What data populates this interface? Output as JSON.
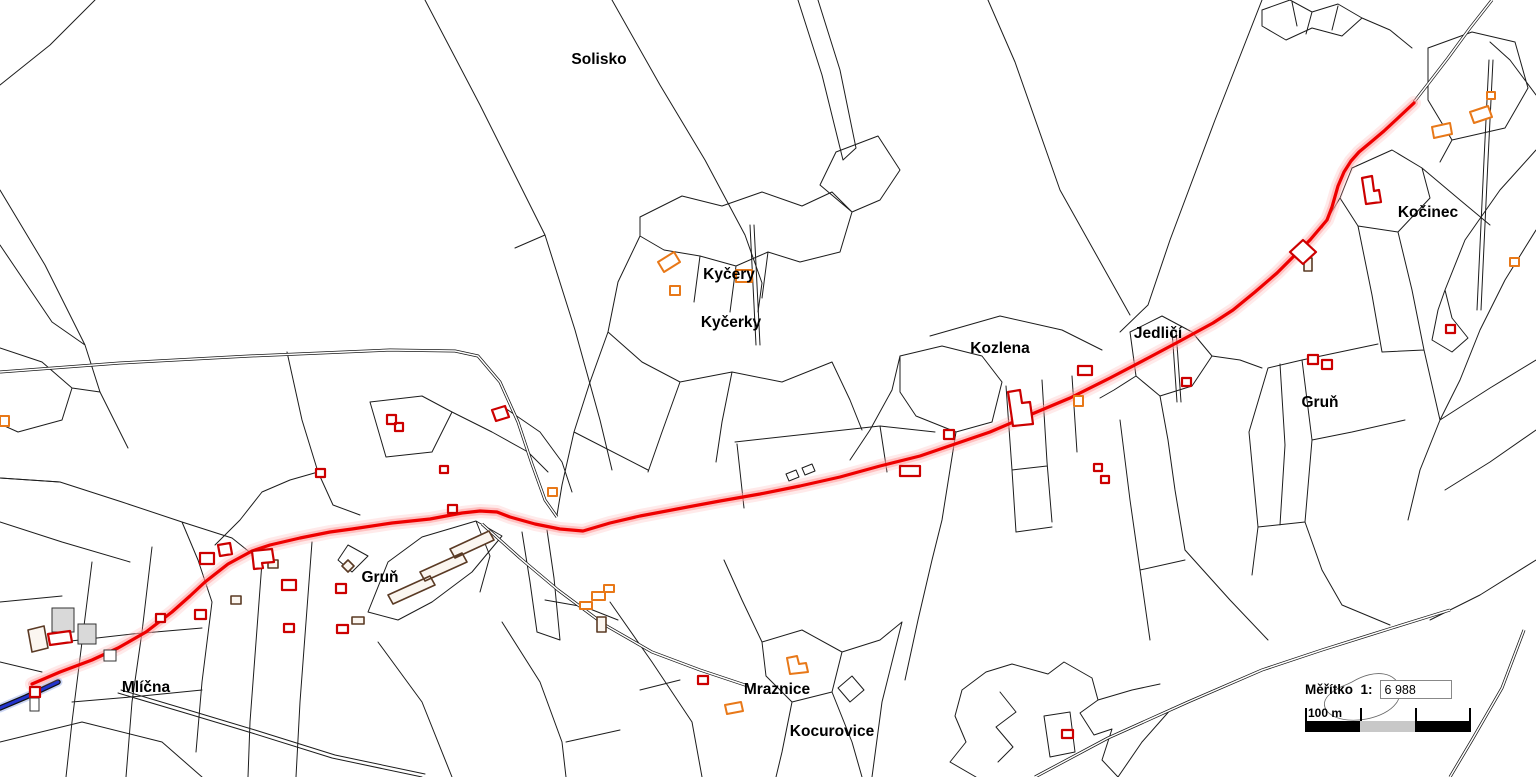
{
  "map": {
    "labels": [
      {
        "id": "solisko",
        "text": "Solisko",
        "x": 599,
        "y": 64
      },
      {
        "id": "kycery",
        "text": "Kyčery",
        "x": 729,
        "y": 279
      },
      {
        "id": "kycerky",
        "text": "Kyčerky",
        "x": 731,
        "y": 327
      },
      {
        "id": "kozlena",
        "text": "Kozlena",
        "x": 1000,
        "y": 353
      },
      {
        "id": "jedlici",
        "text": "Jedličí",
        "x": 1158,
        "y": 338
      },
      {
        "id": "kocinec",
        "text": "Kočinec",
        "x": 1428,
        "y": 217
      },
      {
        "id": "grun-east",
        "text": "Gruň",
        "x": 1320,
        "y": 407
      },
      {
        "id": "grun-west",
        "text": "Gruň",
        "x": 380,
        "y": 582
      },
      {
        "id": "mlicna",
        "text": "Mlíčna",
        "x": 146,
        "y": 692
      },
      {
        "id": "mraznice",
        "text": "Mraznice",
        "x": 777,
        "y": 694
      },
      {
        "id": "kocurovice",
        "text": "Kocurovice",
        "x": 832,
        "y": 736
      }
    ]
  },
  "scale_panel": {
    "label": "Měřítko  1:",
    "value": "6 988",
    "bar_label": "100 m"
  },
  "colors": {
    "route": "#ee0000",
    "route_halo": "#ff9f9f",
    "stream": "#2233cc",
    "stream_halo": "#aabbee",
    "parcel": "#1c1c1c",
    "building_red": "#cc0000",
    "building_orange": "#e87818",
    "building_brown": "#5a3a24",
    "bar_gray": "#c8c8c8"
  }
}
